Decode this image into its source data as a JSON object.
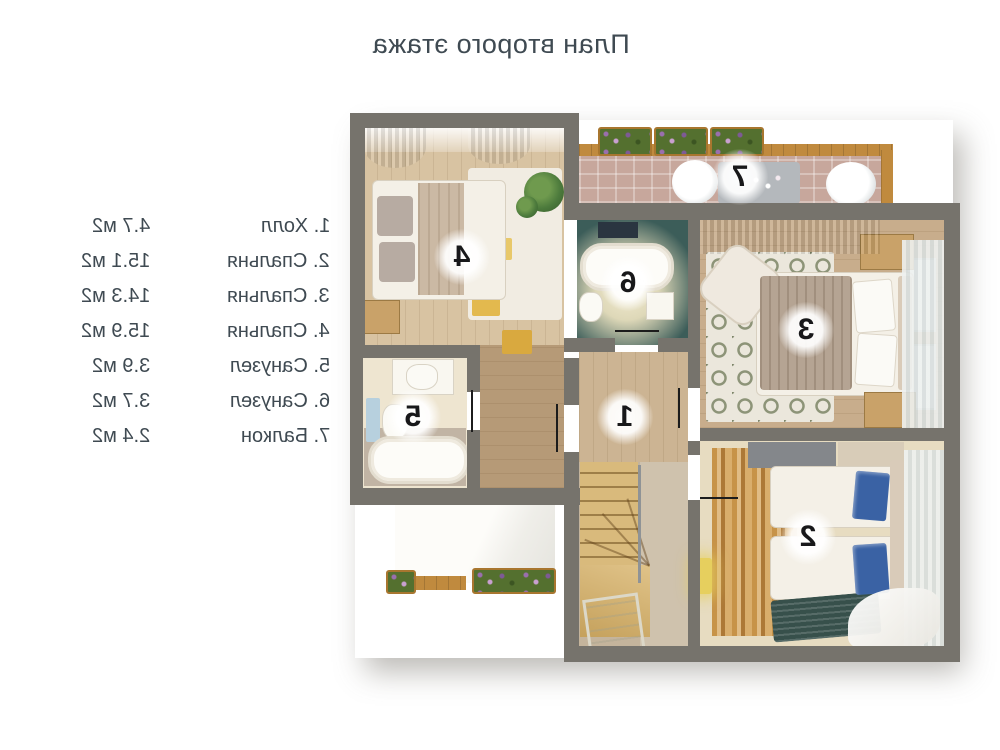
{
  "title": "План второго этажа",
  "legend": {
    "items": [
      {
        "name": "1. Холл",
        "area": "4.7 м2"
      },
      {
        "name": "2. Спальня",
        "area": "15.1 м2"
      },
      {
        "name": "3. Спальня",
        "area": "14.3 м2"
      },
      {
        "name": "4. Спальня",
        "area": "15.9 м2"
      },
      {
        "name": "5. Санузел",
        "area": "3.9 м2"
      },
      {
        "name": "6. Санузел",
        "area": "3.7 м2"
      },
      {
        "name": "7. Балкон",
        "area": "2.4 м2"
      }
    ]
  },
  "plan": {
    "badges": [
      {
        "label": "1"
      },
      {
        "label": "2"
      },
      {
        "label": "3"
      },
      {
        "label": "4"
      },
      {
        "label": "5"
      },
      {
        "label": "6"
      },
      {
        "label": "7"
      }
    ]
  },
  "colors": {
    "text": "#3f4a52",
    "wall": "#76736c",
    "wood-light": "#d8c3a2",
    "wood-mid": "#c8ad8c",
    "wood-dark": "#b69a77",
    "bath-teal": "#3c5d59",
    "brick": "#c7a79c",
    "pillow-blue": "#3a62a4",
    "stair-wood": "#d9ba7c",
    "badge-text": "#18181a"
  }
}
